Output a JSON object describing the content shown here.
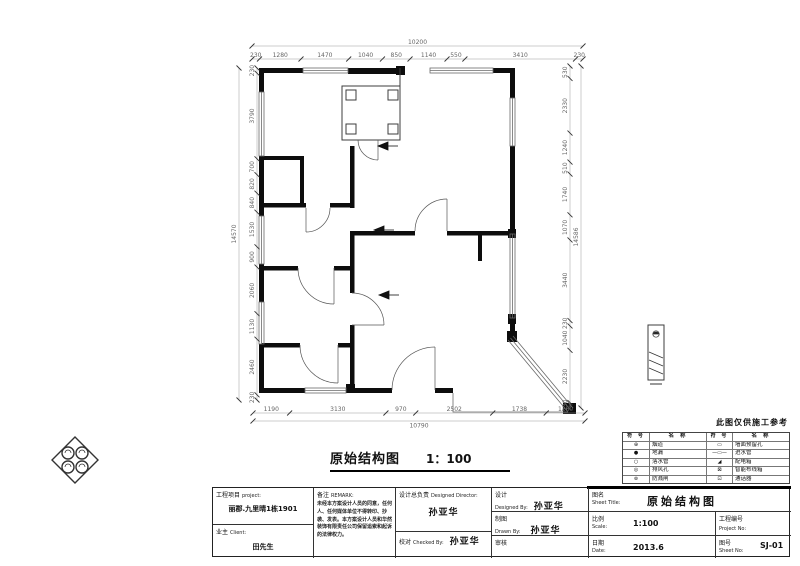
{
  "sheet": {
    "note": "此图仅供施工参考",
    "drawing_title": "原始结构图",
    "drawing_scale": "1：100"
  },
  "plan": {
    "dims": {
      "top": {
        "total": [
          10200
        ],
        "segments": [
          230,
          1280,
          1470,
          1040,
          850,
          1140,
          550,
          3410,
          230
        ]
      },
      "bottom": {
        "total": [
          10790
        ],
        "segments": [
          1190,
          3130,
          970,
          2502,
          1738,
          1260
        ]
      },
      "left": {
        "total": [
          14570
        ],
        "segments": [
          230,
          3790,
          700,
          820,
          840,
          1530,
          900,
          2060,
          1130,
          2460,
          230
        ]
      },
      "right": {
        "total": [
          14586
        ],
        "segments": [
          530,
          2330,
          1240,
          510,
          1740,
          1070,
          3440,
          230,
          1040,
          2230,
          230
        ]
      }
    }
  },
  "legend": {
    "headers": [
      "符 号",
      "名 称",
      "符 号",
      "名 称"
    ],
    "rows": [
      {
        "s1": "circle-cross-icon",
        "n1": "烟道",
        "s2": "slot-icon",
        "n2": "墙面预留孔"
      },
      {
        "s1": "filled-circle-icon",
        "n1": "地漏",
        "s2": "pipe-icon",
        "n2": "进水管"
      },
      {
        "s1": "circle-icon",
        "n1": "落水管",
        "s2": "wedge-icon",
        "n2": "配电箱"
      },
      {
        "s1": "ring-icon",
        "n1": "排风孔",
        "s2": "box-x-icon",
        "n2": "智能布线箱"
      },
      {
        "s1": "double-circle-icon",
        "n1": "防溅闸",
        "s2": "box-dot-icon",
        "n2": "通话器"
      }
    ],
    "glyphs": {
      "circle-cross-icon": "⊕",
      "filled-circle-icon": "●",
      "circle-icon": "○",
      "ring-icon": "◎",
      "double-circle-icon": "⊚",
      "slot-icon": "▭",
      "pipe-icon": "—▭—",
      "wedge-icon": "◢",
      "box-x-icon": "⊠",
      "box-dot-icon": "⊡"
    }
  },
  "titleblock": {
    "project_label": "工程项目",
    "project_label_en": "project:",
    "project_name": "丽郡.九里晴1栋1901",
    "client_label": "业主",
    "client_label_en": "Client:",
    "client_name": "田先生",
    "remark_label": "备注",
    "remark_label_en": "REMARK:",
    "remark_text": "未经本方案设计人员的同意，任何人、任何媒体单位不得转印、抄袭、发表。本方案设计人员和华然装饰有限责任公司保留追索和起诉的法律权力。",
    "director_label": "设计总负责",
    "director_label_en": "Designed Director:",
    "director_name": "孙亚华",
    "checked_label": "校对",
    "checked_label_en": "Checked By:",
    "checked_name": "孙亚华",
    "designed_label": "设计",
    "designed_label_en": "Designed By:",
    "designed_name": "孙亚华",
    "drawn_label": "制图",
    "drawn_label_en": "Drawn By:",
    "drawn_name": "孙亚华",
    "review_label": "审核",
    "review_name": "",
    "sheet_title_label": "图名",
    "sheet_title_label_en": "Sheet Title:",
    "sheet_title": "原始结构图",
    "scale_label": "比例",
    "scale_label_en": "Scale:",
    "scale_value": "1:100",
    "project_no_label": "工程编号",
    "project_no_label_en": "Project No:",
    "project_no_value": "",
    "date_label": "日期",
    "date_label_en": "Date:",
    "date_value": "2013.6",
    "sheet_no_label": "图号",
    "sheet_no_label_en": "Sheet No:",
    "sheet_no_value": "SJ-01"
  }
}
